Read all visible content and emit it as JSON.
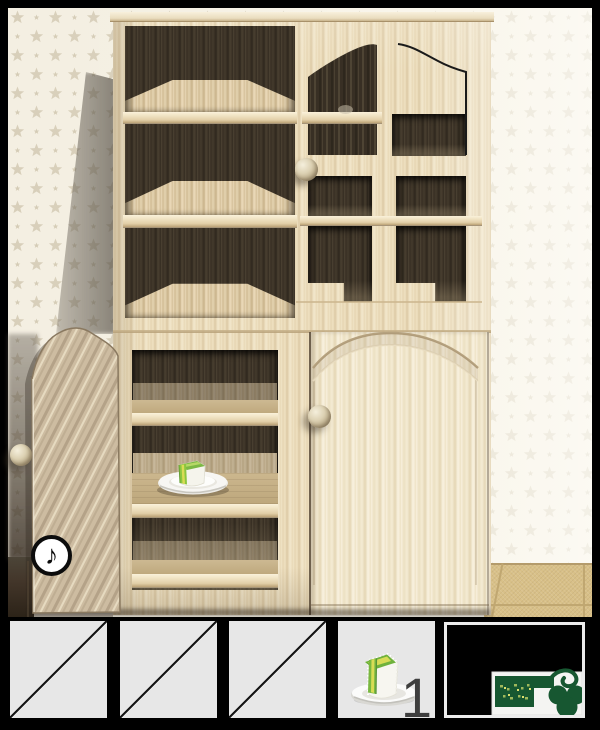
{
  "game": {
    "hud": {
      "music_button": {
        "icon": "music-note-icon",
        "glyph": "♪"
      }
    },
    "scene": {
      "furniture": "wooden-cabinet",
      "items_visible": [
        "cake-slice-on-plate"
      ],
      "doors": [
        "upper-left-open",
        "upper-right-outlined",
        "lower-left-open",
        "lower-right-closed"
      ]
    },
    "inventory": {
      "slots": [
        {
          "id": 1,
          "state": "empty"
        },
        {
          "id": 2,
          "state": "empty"
        },
        {
          "id": 3,
          "state": "empty"
        },
        {
          "id": 4,
          "state": "occupied",
          "item": "cake-slice-on-plate",
          "count": "1"
        },
        {
          "id": 5,
          "state": "item-view",
          "item": "green-key"
        }
      ]
    },
    "colors": {
      "frame": "#000000",
      "slot_bg": "#e7e7e7",
      "slot_border": "#ececec",
      "key_green": "#175731",
      "cake_green": "#7cb844",
      "cake_core_yellow": "#d8dc55",
      "wood_light": "#eee0c0",
      "wood_dark_interior": "#3a3229",
      "wallpaper": "#f4efe2",
      "wallpaper_star": "#d8cfba",
      "floor": "#d8c088",
      "count_text": "#3e3e3e"
    }
  }
}
